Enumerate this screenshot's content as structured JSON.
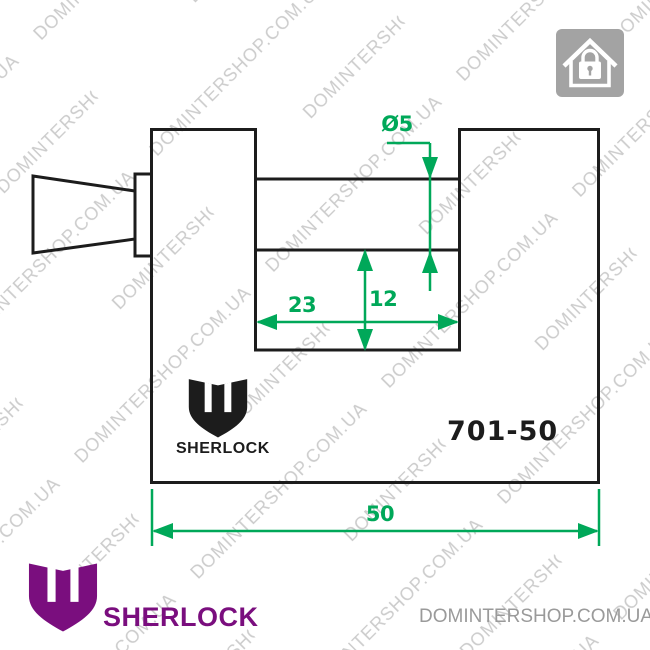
{
  "watermark": {
    "text": "DOMINTERSHOP.COM.UA"
  },
  "drawing": {
    "model": "701-50",
    "brand": "SHERLOCK",
    "dimensions": {
      "hole_diameter": "Ø5",
      "slot_width": "23",
      "slot_depth": "12",
      "total_width": "50"
    }
  },
  "footer": {
    "brand": "SHERLOCK",
    "site": "DOMINTERSHOP.COM.UA"
  },
  "icons": {
    "top_right": "house-with-padlock"
  },
  "colors": {
    "dimension_green": "#00a859",
    "line_black": "#1c1c1c",
    "brand_purple": "#7a0e7e",
    "watermark_gray": "#cccccc",
    "icon_gray": "#a3a3a3",
    "site_text_gray": "#9a9a9a"
  }
}
